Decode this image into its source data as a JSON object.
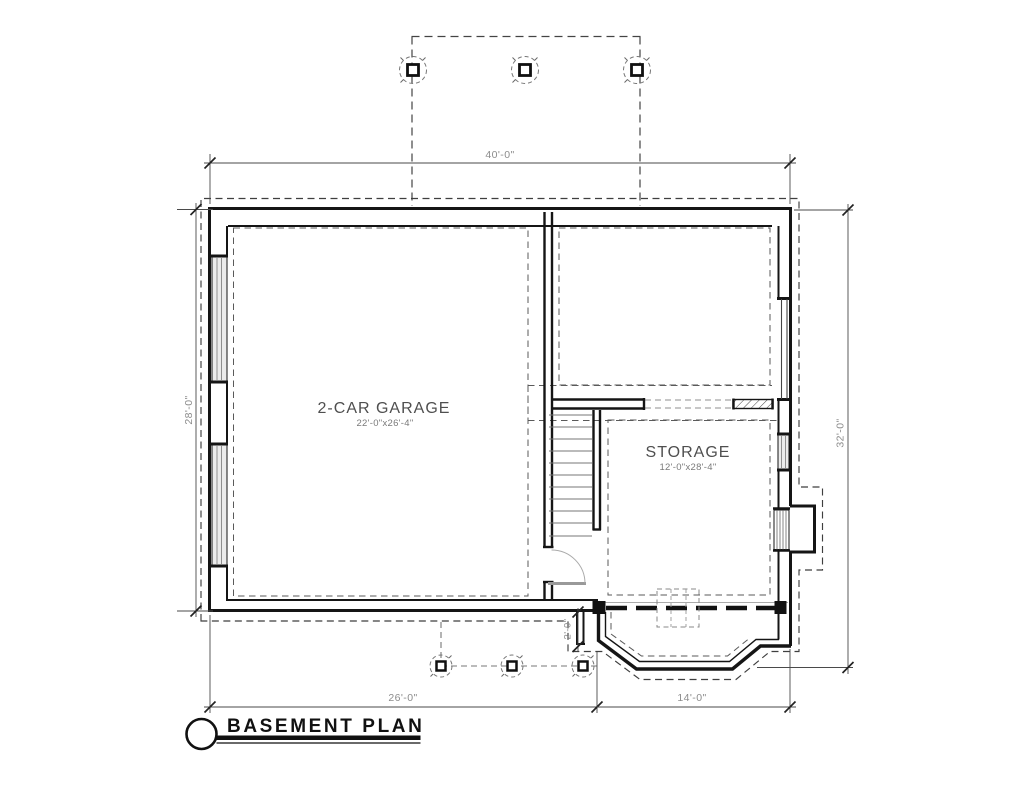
{
  "drawing": {
    "title": "BASEMENT PLAN",
    "rooms": {
      "garage": {
        "name": "2-CAR GARAGE",
        "size": "22'-0\"x26'-4\""
      },
      "storage": {
        "name": "STORAGE",
        "size": "12'-0\"x28'-4\""
      }
    },
    "dimensions": {
      "overall_width": "40'-0\"",
      "left_height": "28'-0\"",
      "right_height": "32'-0\"",
      "bottom_left_width": "26'-0\"",
      "bottom_right_width": "14'-0\"",
      "bay_offset": "2'-0\""
    },
    "colors": {
      "wall": "#151515",
      "dimension_text": "#8c8c8c",
      "label_text": "#4f4f4f",
      "background": "#ffffff"
    }
  }
}
